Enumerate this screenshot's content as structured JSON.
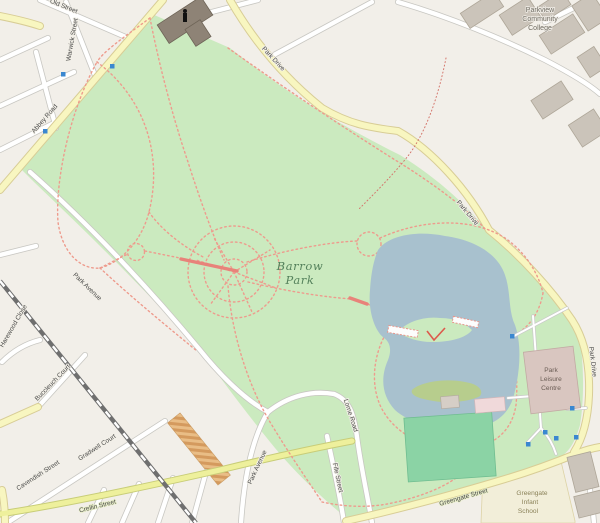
{
  "map": {
    "park": {
      "name_line1": "Barrow",
      "name_line2": "Park"
    },
    "streets": {
      "old": "Old Street",
      "warwick": "Warwick Street",
      "abbey": "Abbey Road",
      "park_drive_top": "Park Drive",
      "park_drive_mid": "Park Drive",
      "park_drive_right": "Park Drive",
      "park_avenue_north": "Park Avenue",
      "park_avenue_south": "Park Avenue",
      "lorne": "Lorne Road",
      "fife": "Fife Street",
      "buccleuch": "Buccleuch Court",
      "cavendish": "Cavendish Street",
      "gradwell": "Gradwell Court",
      "crellin": "Crellin Street",
      "greengate": "Greengate Street",
      "harewood": "Harewood Close"
    },
    "places": {
      "college_line1": "Parkview",
      "college_line2": "Community",
      "college_line3": "College",
      "leisure_line1": "Park",
      "leisure_line2": "Leisure",
      "leisure_line3": "Centre",
      "school_line1": "Greengate",
      "school_line2": "Infant",
      "school_line3": "School"
    },
    "colors": {
      "background": "#f2efe9",
      "park_green": "#cbeabf",
      "water": "#a8c1ce",
      "island_olive": "#b7cd8d",
      "pitch_green": "#8bd3a5",
      "road_yellow": "#f8f6c0",
      "road_yellow_bright": "#eef09c",
      "path_pink": "#ee9b8d",
      "marker_blue": "#3a87d0",
      "building_gray": "#cbc4ba",
      "building_dark": "#8e8376",
      "building_leisure": "#d9c6c0",
      "school_grounds": "#f2eed9"
    }
  }
}
